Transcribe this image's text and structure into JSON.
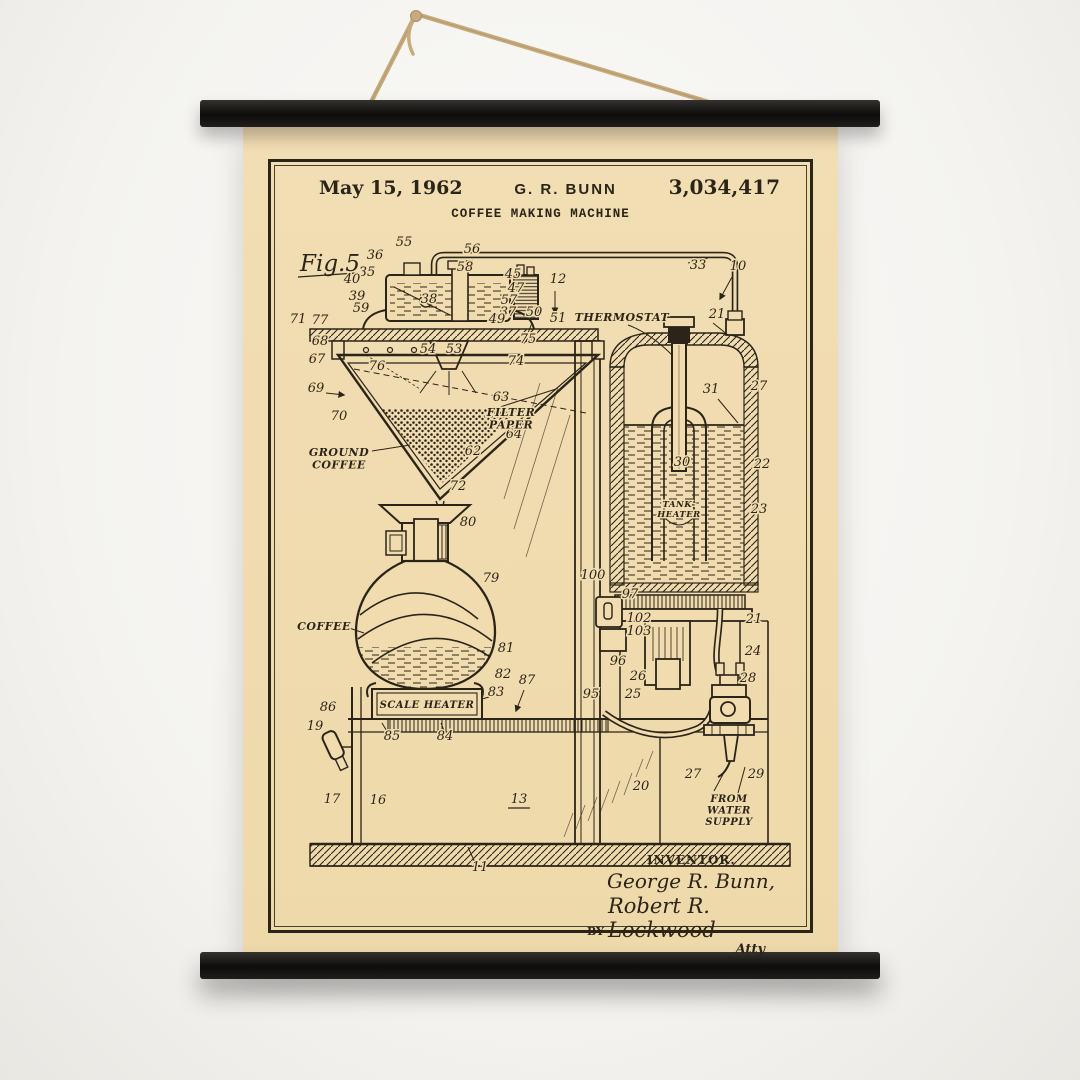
{
  "poster": {
    "colors": {
      "wall": "#f5f4f1",
      "paper": "#f0dcae",
      "ink": "#2b2418",
      "rail": "#141210",
      "rope": "#c7ab7d"
    },
    "header": {
      "date": "May 15, 1962",
      "author": "G. R. BUNN",
      "patent_number": "3,034,417",
      "title": "COFFEE MAKING MACHINE"
    },
    "figure_label": "Fig.5",
    "footer": {
      "inventor_caption": "INVENTOR.",
      "inventor_name": "George R. Bunn,",
      "by_label": "BY",
      "attorney_signature": "Robert R. Lockwood",
      "attorney_monogram": "Atty"
    },
    "diagram": {
      "labels": [
        {
          "lines": [
            "THERMOSTAT"
          ],
          "x": 354,
          "y": 104,
          "size": 11
        },
        {
          "lines": [
            "FILTER",
            "PAPER"
          ],
          "x": 243,
          "y": 199,
          "size": 11
        },
        {
          "lines": [
            "GROUND",
            "COFFEE"
          ],
          "x": 71,
          "y": 239,
          "size": 11
        },
        {
          "lines": [
            "COFFEE"
          ],
          "x": 56,
          "y": 413,
          "size": 11
        },
        {
          "lines": [
            "SCALE HEATER"
          ],
          "x": 159,
          "y": 491,
          "size": 10
        },
        {
          "lines": [
            "TANK-",
            "HEATER"
          ],
          "x": 411,
          "y": 290,
          "size": 8.5
        },
        {
          "lines": [
            "FROM",
            "WATER",
            "SUPPLY"
          ],
          "x": 461,
          "y": 585,
          "size": 10
        }
      ],
      "callouts": [
        {
          "n": "36",
          "x": 107,
          "y": 42
        },
        {
          "n": "35",
          "x": 99,
          "y": 59
        },
        {
          "n": "55",
          "x": 136,
          "y": 29
        },
        {
          "n": "56",
          "x": 204,
          "y": 36
        },
        {
          "n": "58",
          "x": 197,
          "y": 54
        },
        {
          "n": "40",
          "x": 84,
          "y": 66
        },
        {
          "n": "39",
          "x": 89,
          "y": 83
        },
        {
          "n": "59",
          "x": 93,
          "y": 95
        },
        {
          "n": "38",
          "x": 161,
          "y": 86
        },
        {
          "n": "45",
          "x": 245,
          "y": 61
        },
        {
          "n": "47",
          "x": 248,
          "y": 75
        },
        {
          "n": "57",
          "x": 241,
          "y": 87
        },
        {
          "n": "37",
          "x": 240,
          "y": 99
        },
        {
          "n": "12",
          "x": 290,
          "y": 66
        },
        {
          "n": "50",
          "x": 266,
          "y": 99
        },
        {
          "n": "51",
          "x": 290,
          "y": 105
        },
        {
          "n": "49",
          "x": 229,
          "y": 106
        },
        {
          "n": "33",
          "x": 430,
          "y": 52
        },
        {
          "n": "10",
          "x": 470,
          "y": 53
        },
        {
          "n": "75",
          "x": 260,
          "y": 126
        },
        {
          "n": "71",
          "x": 30,
          "y": 106
        },
        {
          "n": "77",
          "x": 52,
          "y": 107
        },
        {
          "n": "68",
          "x": 52,
          "y": 128
        },
        {
          "n": "67",
          "x": 49,
          "y": 146
        },
        {
          "n": "69",
          "x": 48,
          "y": 175
        },
        {
          "n": "70",
          "x": 71,
          "y": 203
        },
        {
          "n": "76",
          "x": 109,
          "y": 153
        },
        {
          "n": "54",
          "x": 160,
          "y": 136
        },
        {
          "n": "53",
          "x": 186,
          "y": 136
        },
        {
          "n": "74",
          "x": 248,
          "y": 148
        },
        {
          "n": "63",
          "x": 233,
          "y": 184
        },
        {
          "n": "64",
          "x": 246,
          "y": 221
        },
        {
          "n": "62",
          "x": 205,
          "y": 238
        },
        {
          "n": "72",
          "x": 190,
          "y": 273
        },
        {
          "n": "80",
          "x": 200,
          "y": 309
        },
        {
          "n": "79",
          "x": 223,
          "y": 365
        },
        {
          "n": "81",
          "x": 238,
          "y": 435
        },
        {
          "n": "82",
          "x": 235,
          "y": 461
        },
        {
          "n": "83",
          "x": 228,
          "y": 479
        },
        {
          "n": "87",
          "x": 259,
          "y": 467
        },
        {
          "n": "86",
          "x": 60,
          "y": 494
        },
        {
          "n": "85",
          "x": 124,
          "y": 523
        },
        {
          "n": "84",
          "x": 177,
          "y": 523
        },
        {
          "n": "19",
          "x": 47,
          "y": 513
        },
        {
          "n": "17",
          "x": 64,
          "y": 586
        },
        {
          "n": "16",
          "x": 110,
          "y": 587
        },
        {
          "n": "13",
          "x": 251,
          "y": 586
        },
        {
          "n": "11",
          "x": 212,
          "y": 654
        },
        {
          "n": "95",
          "x": 323,
          "y": 481
        },
        {
          "n": "96",
          "x": 350,
          "y": 448
        },
        {
          "n": "100",
          "x": 325,
          "y": 362
        },
        {
          "n": "97",
          "x": 362,
          "y": 381
        },
        {
          "n": "102",
          "x": 371,
          "y": 405
        },
        {
          "n": "103",
          "x": 371,
          "y": 418
        },
        {
          "n": "26",
          "x": 370,
          "y": 463
        },
        {
          "n": "25",
          "x": 365,
          "y": 481
        },
        {
          "n": "21",
          "x": 449,
          "y": 101
        },
        {
          "n": "27",
          "x": 491,
          "y": 173
        },
        {
          "n": "31",
          "x": 443,
          "y": 176
        },
        {
          "n": "30",
          "x": 414,
          "y": 249
        },
        {
          "n": "22",
          "x": 494,
          "y": 251
        },
        {
          "n": "23",
          "x": 491,
          "y": 296
        },
        {
          "n": "20",
          "x": 373,
          "y": 573
        },
        {
          "n": "21",
          "x": 486,
          "y": 406
        },
        {
          "n": "24",
          "x": 485,
          "y": 438
        },
        {
          "n": "28",
          "x": 480,
          "y": 465
        },
        {
          "n": "29",
          "x": 488,
          "y": 561
        },
        {
          "n": "27",
          "x": 425,
          "y": 561
        }
      ]
    }
  }
}
